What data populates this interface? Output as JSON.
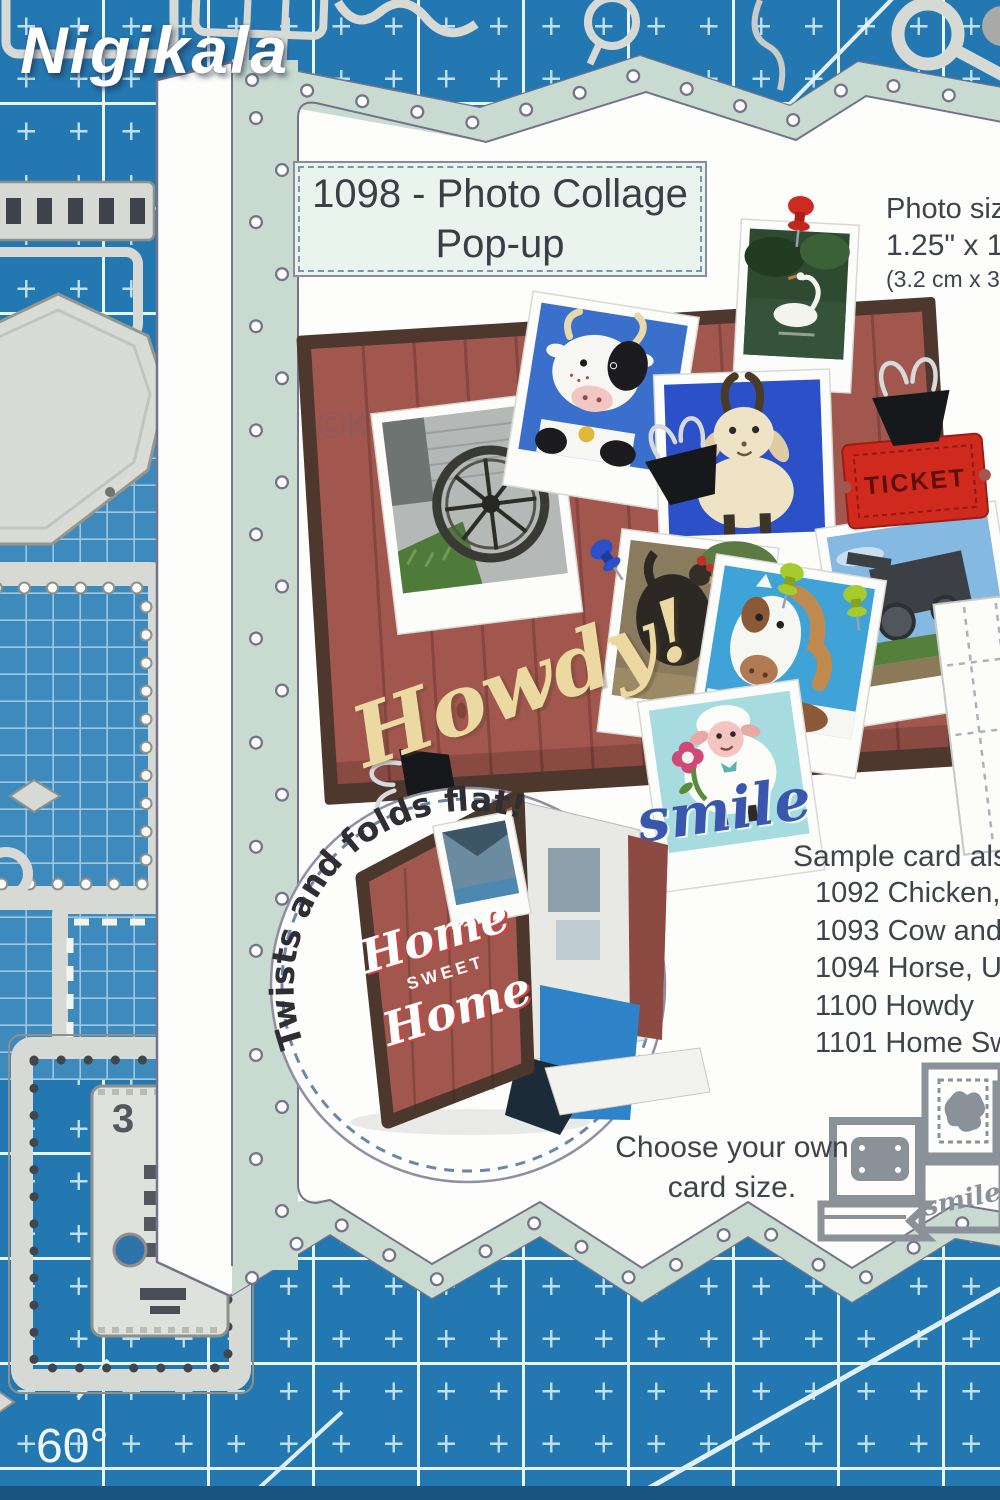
{
  "brand_watermark": "Nigikala",
  "artist_watermark": "©Karen Burniston",
  "mat": {
    "angle_label": "60°"
  },
  "title": {
    "line1": "1098 - Photo Collage",
    "line2": "Pop-up"
  },
  "photo_size": {
    "line1": "Photo siz",
    "line2": "1.25\" x 1.2",
    "line3": "(3.2 cm x 3.2"
  },
  "collage": {
    "howdy": "Howdy!",
    "smile": "smile",
    "ticket": "TICKET"
  },
  "inset": {
    "caption": "Twists and folds flat!",
    "home1": "Home",
    "home2": "SWEET",
    "home3": "Home"
  },
  "samples": {
    "heading": "Sample card also",
    "items": [
      "1092 Chicken, P",
      "1093 Cow and G",
      "1094 Horse, Uni",
      "1100 Howdy",
      "1101 Home Swee"
    ]
  },
  "choose": {
    "line1": "Choose your own",
    "line2": "card size."
  },
  "dies": {
    "smile_label": "smile",
    "ticket_label": "3"
  }
}
